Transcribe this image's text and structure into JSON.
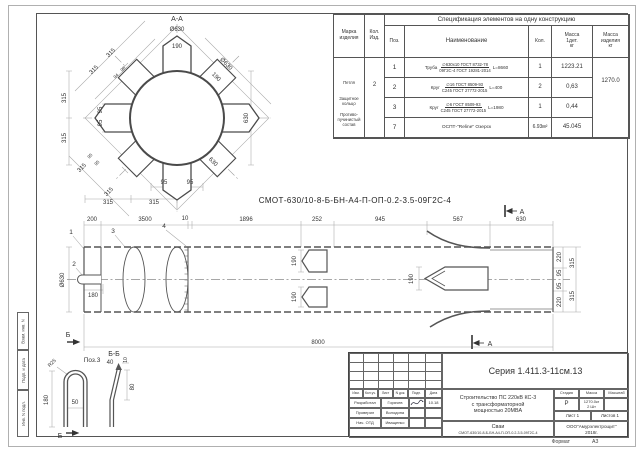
{
  "page": {
    "format_label": "Формат",
    "format_value": "А3"
  },
  "designation": "СМОТ-630/10-8-Б-БН-А4-П-ОП-0.2-3.5-09Г2С-4",
  "sidebar": {
    "cells": [
      "Взам. инв. N",
      "Подп. и дата",
      "Инв. N подл."
    ]
  },
  "spec_table": {
    "title": "Спецификация элементов на одну конструкцию",
    "headers": {
      "marka": "Марка\nизделия",
      "kol_izd": "Кол.\nИзд.",
      "poz": "Поз.",
      "name": "Наименование",
      "kol": "Кол.",
      "mass_det": "Масса\n1дет.\nкг",
      "mass_izd": "Масса\nизделия\nкг"
    },
    "marka_items": [
      "Петля",
      "Защитное\nкольцо",
      "Противо-\nпучинистый\nсостав"
    ],
    "kol_izd_value": "2",
    "mass_izd_value": "1270.0",
    "rows": [
      {
        "poz": "1",
        "prefix": "Труба",
        "frac_top": "∅630х10 ГОСТ 8732-78",
        "frac_bottom": "09Г2С-4 ГОСТ 19281-2014",
        "length": "L=8660",
        "kol": "1",
        "mass": "1223.21"
      },
      {
        "poz": "2",
        "prefix": "Круг",
        "frac_top": "∅16 ГОСТ 8509-93",
        "frac_bottom": "С245 ГОСТ 27772-2015",
        "length": "L=400",
        "kol": "2",
        "mass": "0,63"
      },
      {
        "poz": "3",
        "prefix": "Круг",
        "frac_top": "∅6 ГОСТ 8509-93",
        "frac_bottom": "С245 ГОСТ 27772-2015",
        "length": "L=1980",
        "kol": "1",
        "mass": "0,44"
      },
      {
        "poz": "7",
        "single": "ОСПТ-\"Reline\" Озерск",
        "kol": "6.93м²",
        "mass": "45.045"
      }
    ]
  },
  "section_view": {
    "labels": [
      {
        "t": "А-А",
        "x": 122,
        "y": 13,
        "s": 7,
        "n": "section-title-aa"
      },
      {
        "t": "Ø630",
        "x": 122,
        "y": 23
      },
      {
        "t": "190",
        "x": 122,
        "y": 40
      },
      {
        "t": "315",
        "x": 57,
        "y": 46,
        "r": -45
      },
      {
        "t": "315",
        "x": 40,
        "y": 63,
        "r": -45
      },
      {
        "t": "94",
        "x": 62,
        "y": 69,
        "r": -45,
        "s": 4.5
      },
      {
        "t": "96",
        "x": 69,
        "y": 62,
        "r": -45,
        "s": 4.5
      },
      {
        "t": "Ø630",
        "x": 170,
        "y": 57,
        "r": 45
      },
      {
        "t": "190",
        "x": 160,
        "y": 70,
        "r": 45
      },
      {
        "t": "630",
        "x": 193,
        "y": 110,
        "r": -90
      },
      {
        "t": "315",
        "x": 11,
        "y": 90,
        "r": -90
      },
      {
        "t": "315",
        "x": 11,
        "y": 130,
        "r": -90
      },
      {
        "t": "95",
        "x": 47,
        "y": 102,
        "r": -90
      },
      {
        "t": "95",
        "x": 47,
        "y": 115,
        "r": -90
      },
      {
        "t": "95",
        "x": 36,
        "y": 149,
        "r": -45,
        "s": 4.5
      },
      {
        "t": "95",
        "x": 43,
        "y": 156,
        "r": -45,
        "s": 4.5
      },
      {
        "t": "315",
        "x": 28,
        "y": 161,
        "r": -45
      },
      {
        "t": "315",
        "x": 55,
        "y": 185,
        "r": -45
      },
      {
        "t": "95",
        "x": 109,
        "y": 176
      },
      {
        "t": "95",
        "x": 135,
        "y": 176
      },
      {
        "t": "630",
        "x": 157,
        "y": 155,
        "r": 45
      },
      {
        "t": "315",
        "x": 53,
        "y": 196
      },
      {
        "t": "315",
        "x": 99,
        "y": 196
      }
    ]
  },
  "main_view": {
    "labels": [
      {
        "t": "200",
        "x": 37,
        "y": 16
      },
      {
        "t": "3500",
        "x": 90,
        "y": 16
      },
      {
        "t": "10",
        "x": 130,
        "y": 15
      },
      {
        "t": "1896",
        "x": 191,
        "y": 16
      },
      {
        "t": "252",
        "x": 262,
        "y": 16
      },
      {
        "t": "945",
        "x": 325,
        "y": 16
      },
      {
        "t": "567",
        "x": 403,
        "y": 16
      },
      {
        "t": "630",
        "x": 466,
        "y": 16
      },
      {
        "t": "8000",
        "x": 263,
        "y": 139
      },
      {
        "t": "Ø630",
        "x": 9,
        "y": 75,
        "r": -90
      },
      {
        "t": "180",
        "x": 38,
        "y": 92
      },
      {
        "t": "1",
        "x": 16,
        "y": 29,
        "s": 6.5,
        "n": "callout-1"
      },
      {
        "t": "2",
        "x": 19,
        "y": 61,
        "s": 6.5,
        "n": "callout-2"
      },
      {
        "t": "3",
        "x": 58,
        "y": 28,
        "s": 6.5,
        "n": "callout-3"
      },
      {
        "t": "4",
        "x": 109,
        "y": 23,
        "s": 6.5,
        "n": "callout-4"
      },
      {
        "t": "190",
        "x": 241,
        "y": 56,
        "r": -90
      },
      {
        "t": "190",
        "x": 241,
        "y": 92,
        "r": -90
      },
      {
        "t": "190",
        "x": 358,
        "y": 74,
        "r": -90
      },
      {
        "t": "220",
        "x": 506,
        "y": 52,
        "r": -90
      },
      {
        "t": "95",
        "x": 506,
        "y": 68,
        "r": -90
      },
      {
        "t": "95",
        "x": 506,
        "y": 81,
        "r": -90
      },
      {
        "t": "220",
        "x": 506,
        "y": 97,
        "r": -90
      },
      {
        "t": "315",
        "x": 519,
        "y": 58,
        "r": -90
      },
      {
        "t": "315",
        "x": 519,
        "y": 91,
        "r": -90
      },
      {
        "t": "А",
        "x": 467,
        "y": 9,
        "s": 7,
        "n": "section-mark-a"
      },
      {
        "t": "А",
        "x": 435,
        "y": 141,
        "s": 7,
        "n": "section-mark-a"
      },
      {
        "t": "Б",
        "x": 13,
        "y": 132,
        "s": 7,
        "n": "section-mark-b"
      }
    ]
  },
  "detail_view": {
    "labels": [
      {
        "t": "Поз.3",
        "x": 62,
        "y": 14,
        "s": 6.5,
        "n": "pos3-label"
      },
      {
        "t": "R25",
        "x": 23,
        "y": 16,
        "r": -45,
        "s": 5
      },
      {
        "t": "180",
        "x": 18,
        "y": 52,
        "r": -90
      },
      {
        "t": "50",
        "x": 45,
        "y": 56
      },
      {
        "t": "Б-Б",
        "x": 84,
        "y": 8,
        "s": 7,
        "n": "section-title-bb"
      },
      {
        "t": "40",
        "x": 80,
        "y": 16
      },
      {
        "t": "10",
        "x": 97,
        "y": 12,
        "r": -90,
        "s": 5
      },
      {
        "t": "80",
        "x": 104,
        "y": 39,
        "r": -90
      },
      {
        "t": "Б",
        "x": 30,
        "y": 90,
        "s": 7,
        "n": "section-mark-b"
      }
    ]
  },
  "title_block": {
    "series": "Серия 1.411.3-11см.13",
    "rev_headers": [
      "Изм.",
      "Кол.уч.",
      "Лист",
      "N док.",
      "Подп.",
      "Дата"
    ],
    "sig_rows": [
      {
        "role": "Разработал",
        "name": "Горячев",
        "date": "10.18"
      },
      {
        "role": "Проверил",
        "name": "Володина",
        "date": ""
      },
      {
        "role": "Нач. ОТД",
        "name": "Иващенко",
        "date": ""
      }
    ],
    "project": "Строительство ПС 220кВ  КС-3\nс трансформаторной\nмощностью 20МВА",
    "object": "Сваи",
    "object_code": "СМОТ-630/10-8-Б-БН-А4-П-ОП-0.2-3.5-09Г2С-4",
    "stage_label": "Стадия",
    "mass_label": "Масса",
    "scale_label": "Масштаб",
    "stage_value": "Р",
    "mass_value": "1270.0кг\n2 Шт",
    "scale_value": "",
    "sheet_info": "Лист 1",
    "sheets_info": "Листов 1",
    "company": "ООО\"Амурэлектрощит\"\n2018г."
  }
}
